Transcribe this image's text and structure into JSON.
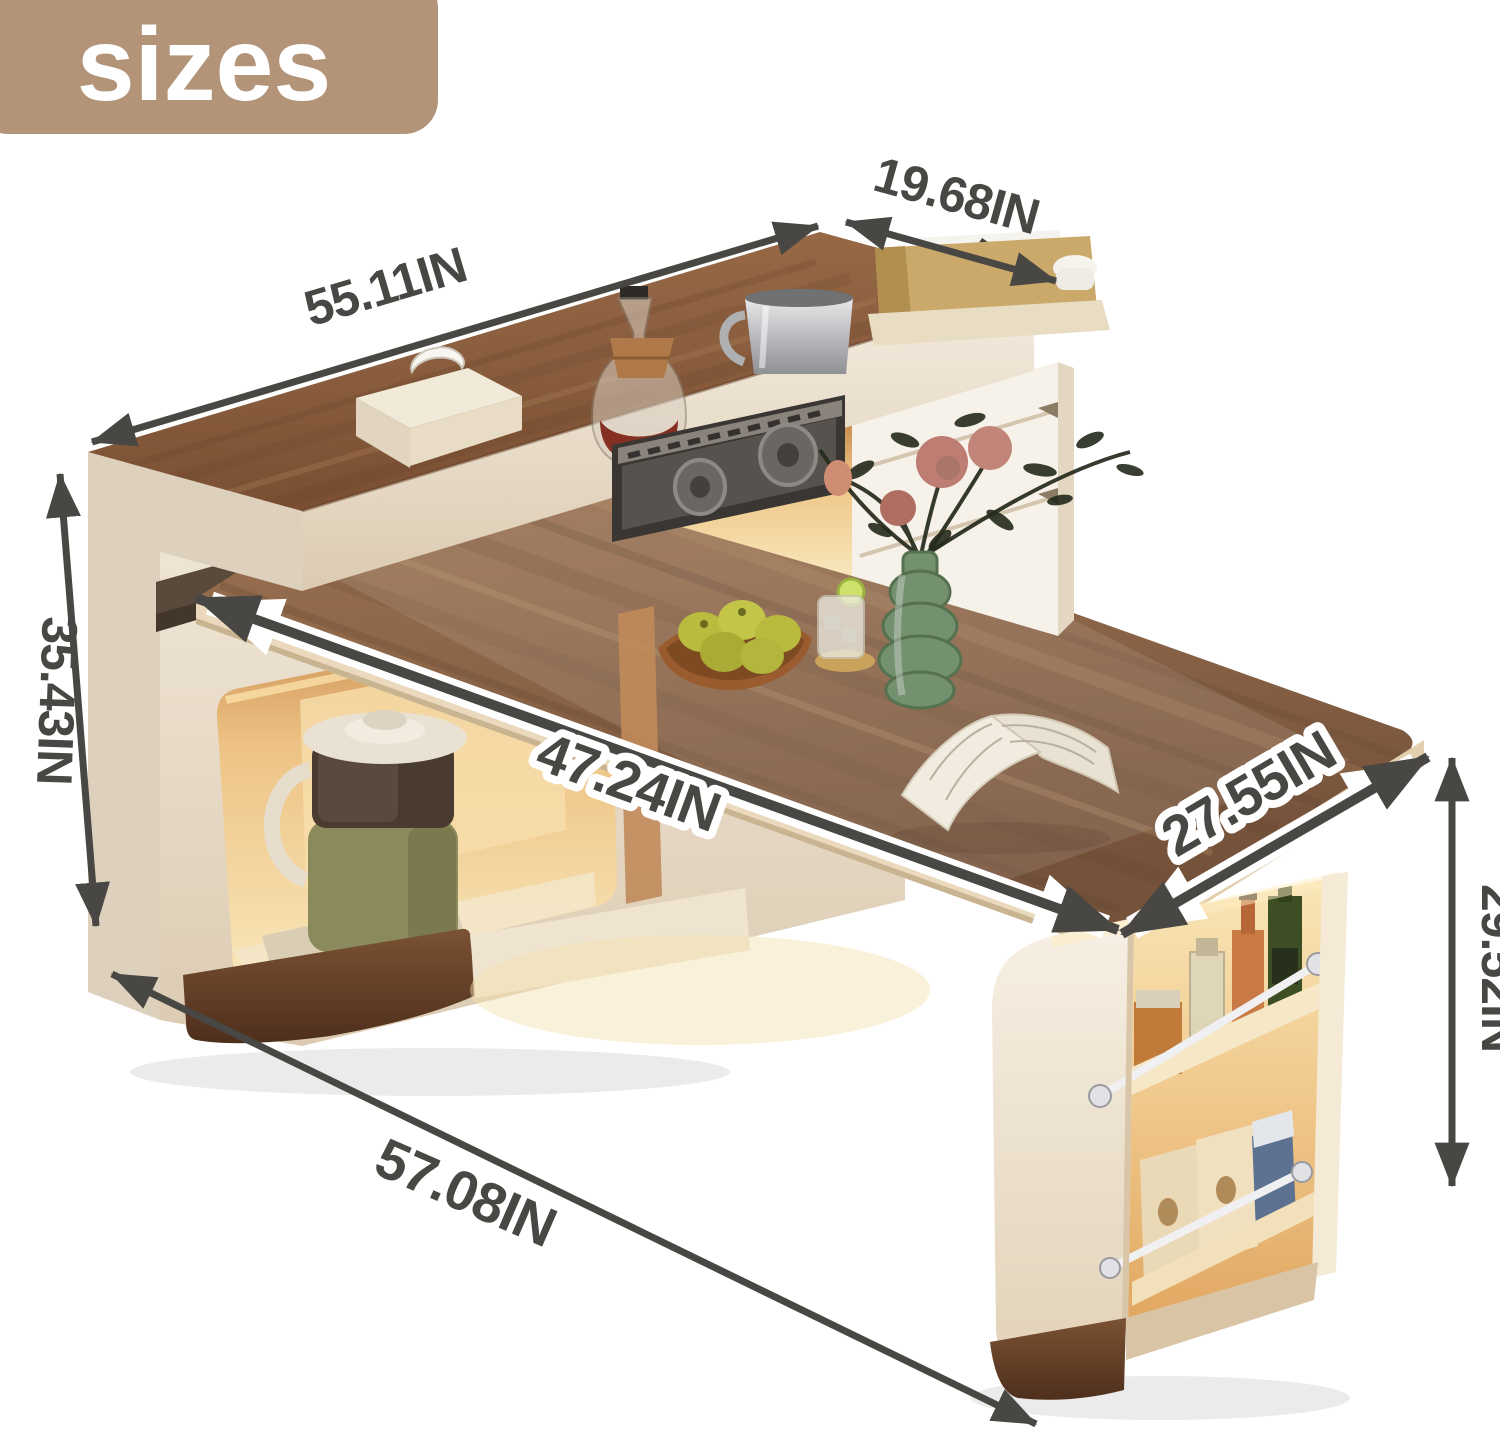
{
  "badge": {
    "label": "sizes"
  },
  "dimensions": {
    "counter_length": {
      "label": "55.11IN"
    },
    "counter_depth": {
      "label": "19.68IN"
    },
    "island_height": {
      "label": "35.43IN"
    },
    "table_length": {
      "label": "47.24IN"
    },
    "table_width": {
      "label": "27.55IN"
    },
    "table_height": {
      "label": "29.52IN"
    },
    "overall_length": {
      "label": "57.08IN"
    }
  },
  "colors": {
    "badge-bg": "#b39478",
    "ink": "#494744",
    "wood-mid": "#8a5e3e",
    "wood-dark": "#66412a",
    "wood-light": "#aa7e55",
    "twood-mid": "#8f684a",
    "twood-dark": "#5f432e",
    "twood-light": "#b7916b",
    "cream": "#ece2d3",
    "cream-bright": "#f6efe3",
    "cream-dark": "#d9c9b2",
    "cream-edge": "#c4b097",
    "glow-bright": "#f8e3b2",
    "glow-mid": "#eeb976",
    "glow-deep": "#d79a55",
    "base-wood": "#5d3a25",
    "panel-dark": "#3a3633",
    "panel-mid": "#57524d",
    "steel": "#c9cbcd",
    "green-glass": "#73906f",
    "rose": "#bd7d72",
    "apple": "#b9bb3e",
    "leaf": "#242a1c"
  }
}
